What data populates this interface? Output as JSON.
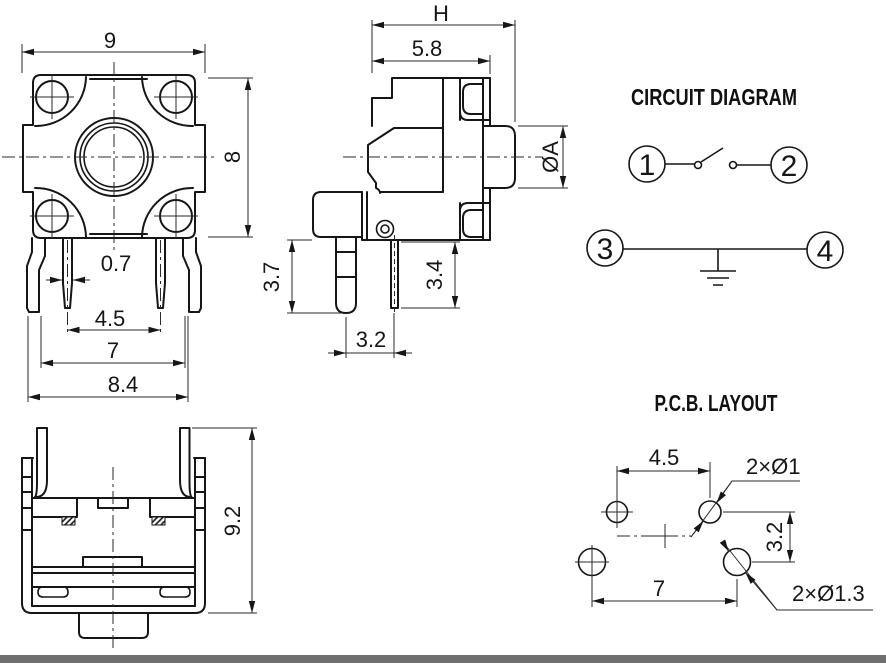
{
  "colors": {
    "background": "#ffffff",
    "line": "#161616",
    "footer_bar": "#6f6f6f"
  },
  "top_view": {
    "dim_width": "9",
    "dim_height": "8",
    "dim_pin_width": "0.7",
    "dim_inner_pin_spacing": "4.5",
    "dim_outer_pin_spacing": "7",
    "dim_pin_span": "8.4"
  },
  "side_view": {
    "dim_total_width": "H",
    "dim_body_width": "5.8",
    "dim_actuator_diameter": "ØA",
    "dim_left_pin_length": "3.7",
    "dim_right_pin_length": "3.4",
    "dim_pin_spacing": "3.2"
  },
  "front_view": {
    "dim_height": "9.2"
  },
  "circuit_diagram": {
    "title": "CIRCUIT DIAGRAM",
    "terminals": [
      "1",
      "2",
      "3",
      "4"
    ]
  },
  "pcb_layout": {
    "title": "P.C.B. LAYOUT",
    "dim_upper_hole_spacing": "4.5",
    "dim_row_spacing": "3.2",
    "dim_lower_hole_spacing": "7",
    "label_upper_holes": "2×Ø1",
    "label_lower_holes": "2×Ø1.3"
  }
}
